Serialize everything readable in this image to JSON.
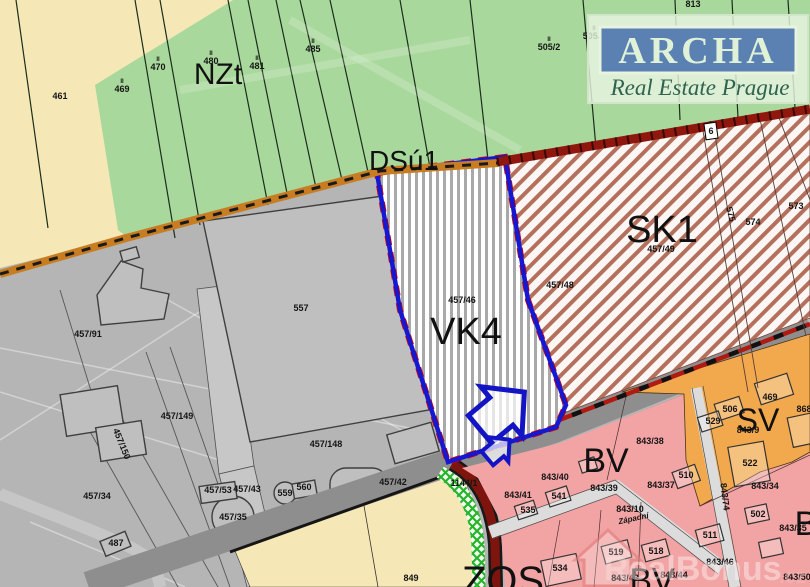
{
  "map": {
    "zones": [
      {
        "id": "nzt",
        "label": "NZt",
        "x": 218,
        "y": 84,
        "size": 30
      },
      {
        "id": "dsu1",
        "label": "DSú1",
        "x": 404,
        "y": 170,
        "size": 28
      },
      {
        "id": "vk4",
        "label": "VK4",
        "x": 466,
        "y": 344,
        "size": 38
      },
      {
        "id": "sk1",
        "label": "SK1",
        "x": 662,
        "y": 242,
        "size": 38
      },
      {
        "id": "bv-upper",
        "label": "BV",
        "x": 606,
        "y": 472,
        "size": 34
      },
      {
        "id": "sv",
        "label": "SV",
        "x": 758,
        "y": 431,
        "size": 32
      },
      {
        "id": "b-right",
        "label": "B",
        "x": 806,
        "y": 535,
        "size": 34
      },
      {
        "id": "bv-lower",
        "label": "BV",
        "x": 652,
        "y": 592,
        "size": 34
      },
      {
        "id": "zos",
        "label": "ZOS",
        "x": 503,
        "y": 594,
        "size": 40
      }
    ],
    "parcels": [
      {
        "t": "461",
        "x": 60,
        "y": 99
      },
      {
        "t": "469",
        "x": 122,
        "y": 92,
        "tick": true
      },
      {
        "t": "470",
        "x": 158,
        "y": 70,
        "tick": true
      },
      {
        "t": "480",
        "x": 211,
        "y": 64,
        "tick": true
      },
      {
        "t": "481",
        "x": 257,
        "y": 69,
        "tick": true
      },
      {
        "t": "485",
        "x": 313,
        "y": 52,
        "tick": true
      },
      {
        "t": "505/2",
        "x": 549,
        "y": 50,
        "tick": true
      },
      {
        "t": "505/1",
        "x": 594,
        "y": 39,
        "tick": true
      },
      {
        "t": "813",
        "x": 693,
        "y": 7
      },
      {
        "t": "457/91",
        "x": 88,
        "y": 337
      },
      {
        "t": "557",
        "x": 301,
        "y": 311
      },
      {
        "t": "457/149",
        "x": 177,
        "y": 419
      },
      {
        "t": "457/150",
        "x": 119,
        "y": 445,
        "r": 68
      },
      {
        "t": "457/148",
        "x": 326,
        "y": 447
      },
      {
        "t": "457/34",
        "x": 97,
        "y": 499
      },
      {
        "t": "487",
        "x": 116,
        "y": 546
      },
      {
        "t": "457/53",
        "x": 218,
        "y": 493
      },
      {
        "t": "457/43",
        "x": 247,
        "y": 492
      },
      {
        "t": "457/35",
        "x": 233,
        "y": 520
      },
      {
        "t": "559",
        "x": 285,
        "y": 496
      },
      {
        "t": "560",
        "x": 304,
        "y": 490
      },
      {
        "t": "457/42",
        "x": 393,
        "y": 485
      },
      {
        "t": "1144/1",
        "x": 464,
        "y": 486
      },
      {
        "t": "457/46",
        "x": 462,
        "y": 303
      },
      {
        "t": "457/49",
        "x": 661,
        "y": 252
      },
      {
        "t": "457/48",
        "x": 560,
        "y": 288
      },
      {
        "t": "574",
        "x": 753,
        "y": 225
      },
      {
        "t": "573",
        "x": 796,
        "y": 209
      },
      {
        "t": "575",
        "x": 728,
        "y": 215,
        "r": 75
      },
      {
        "t": "6",
        "x": 711,
        "y": 134
      },
      {
        "t": "843/38",
        "x": 650,
        "y": 444
      },
      {
        "t": "843/40",
        "x": 555,
        "y": 480
      },
      {
        "t": "843/39",
        "x": 604,
        "y": 491
      },
      {
        "t": "843/37",
        "x": 661,
        "y": 488
      },
      {
        "t": "843/41",
        "x": 518,
        "y": 498
      },
      {
        "t": "535",
        "x": 528,
        "y": 513
      },
      {
        "t": "541",
        "x": 559,
        "y": 499
      },
      {
        "t": "510",
        "x": 686,
        "y": 478
      },
      {
        "t": "843/10",
        "x": 630,
        "y": 512
      },
      {
        "t": "Západní",
        "x": 634,
        "y": 521,
        "r": -12,
        "it": true
      },
      {
        "t": "843/34",
        "x": 765,
        "y": 489
      },
      {
        "t": "502",
        "x": 758,
        "y": 517
      },
      {
        "t": "843/9",
        "x": 748,
        "y": 433
      },
      {
        "t": "469",
        "x": 770,
        "y": 400
      },
      {
        "t": "506",
        "x": 730,
        "y": 412
      },
      {
        "t": "529",
        "x": 713,
        "y": 424
      },
      {
        "t": "522",
        "x": 750,
        "y": 466
      },
      {
        "t": "868",
        "x": 804,
        "y": 412
      },
      {
        "t": "843/35",
        "x": 793,
        "y": 531
      },
      {
        "t": "534",
        "x": 560,
        "y": 571
      },
      {
        "t": "519",
        "x": 616,
        "y": 555
      },
      {
        "t": "518",
        "x": 656,
        "y": 554
      },
      {
        "t": "511",
        "x": 710,
        "y": 538
      },
      {
        "t": "843/43",
        "x": 625,
        "y": 581
      },
      {
        "t": "843/44",
        "x": 674,
        "y": 578
      },
      {
        "t": "843/46",
        "x": 720,
        "y": 565
      },
      {
        "t": "843/50",
        "x": 797,
        "y": 580
      },
      {
        "t": "843/74",
        "x": 722,
        "y": 497,
        "r": 83
      },
      {
        "t": "849",
        "x": 411,
        "y": 581
      }
    ],
    "watermarks": {
      "archa": {
        "title": "ARCHA",
        "subtitle": "Real Estate Prague"
      },
      "realbonus": {
        "name": "RealBonus",
        "tld": ".cz"
      }
    },
    "colors": {
      "field_green": "#a9d89c",
      "field_yellow": "#f6e8b6",
      "built_gray": "#b5b5b5",
      "road_dark_gray": "#8e8e8e",
      "residential_pink": "#f2a3a3",
      "mixed_orange": "#f2a94e",
      "vk4_outline_blue": "#1717cf",
      "vk4_dash_red": "#d40000",
      "sk1_hatch_red": "#b4705c",
      "road_orange": "#c87d22",
      "road_maroon": "#7d150e",
      "lattice_green": "#27b32a",
      "archa_panel_blue": "#5b80b2"
    }
  }
}
